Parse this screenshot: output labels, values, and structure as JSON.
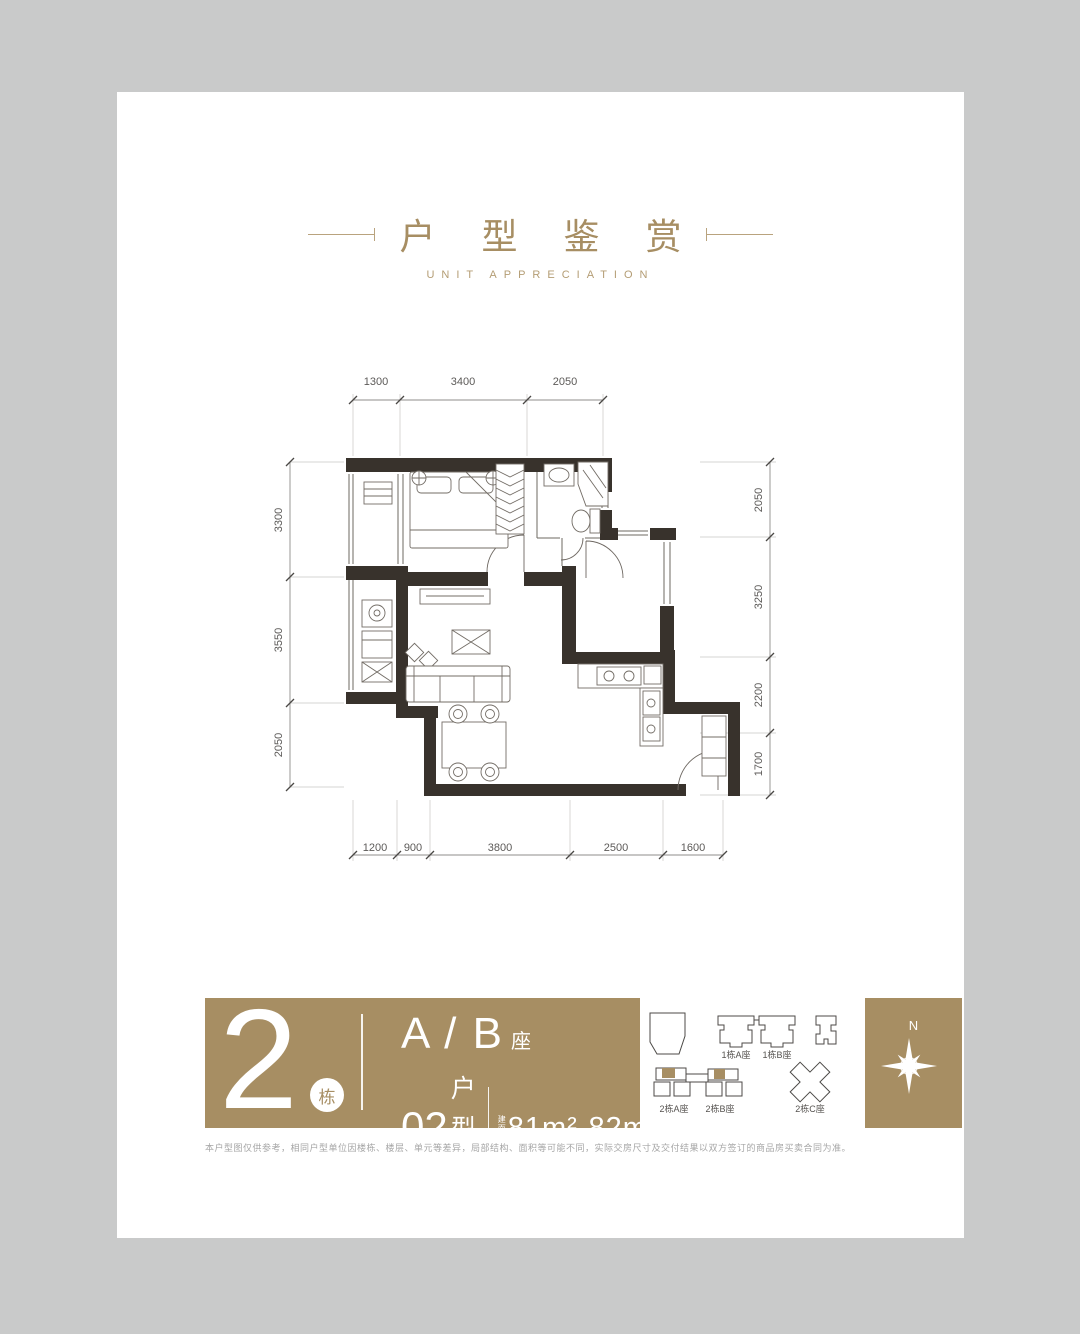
{
  "header": {
    "title_cn": "户 型 鉴 赏",
    "title_en": "UNIT APPRECIATION"
  },
  "floorplan": {
    "dimensions": {
      "top": [
        "1300",
        "3400",
        "2050"
      ],
      "bottom": [
        "1200",
        "900",
        "3800",
        "2500",
        "1600"
      ],
      "left": [
        "3300",
        "3550",
        "2050"
      ],
      "right": [
        "2050",
        "3250",
        "2200",
        "1700"
      ]
    }
  },
  "info_bar": {
    "building_number": "2",
    "building_suffix": "栋",
    "block": "A / B",
    "block_suffix": "座",
    "unit_number": "02",
    "unit_suffix": "户型",
    "area_prefix": "建面约",
    "area_range": "81m²-82m²"
  },
  "site_map": {
    "labels": [
      "1栋A座",
      "1栋B座",
      "2栋A座",
      "2栋B座",
      "2栋C座"
    ]
  },
  "compass": {
    "north_label": "N"
  },
  "footer": {
    "disclaimer": "本户型图仅供参考，相同户型单位因楼栋、楼层、单元等差异，局部结构、面积等可能不同，实际交房尺寸及交付结果以双方签订的商品房买卖合同为准。"
  },
  "colors": {
    "accent_gold": "#a78e63",
    "wall": "#38322c",
    "page_bg": "#ffffff",
    "outer_bg": "#c9caca"
  }
}
